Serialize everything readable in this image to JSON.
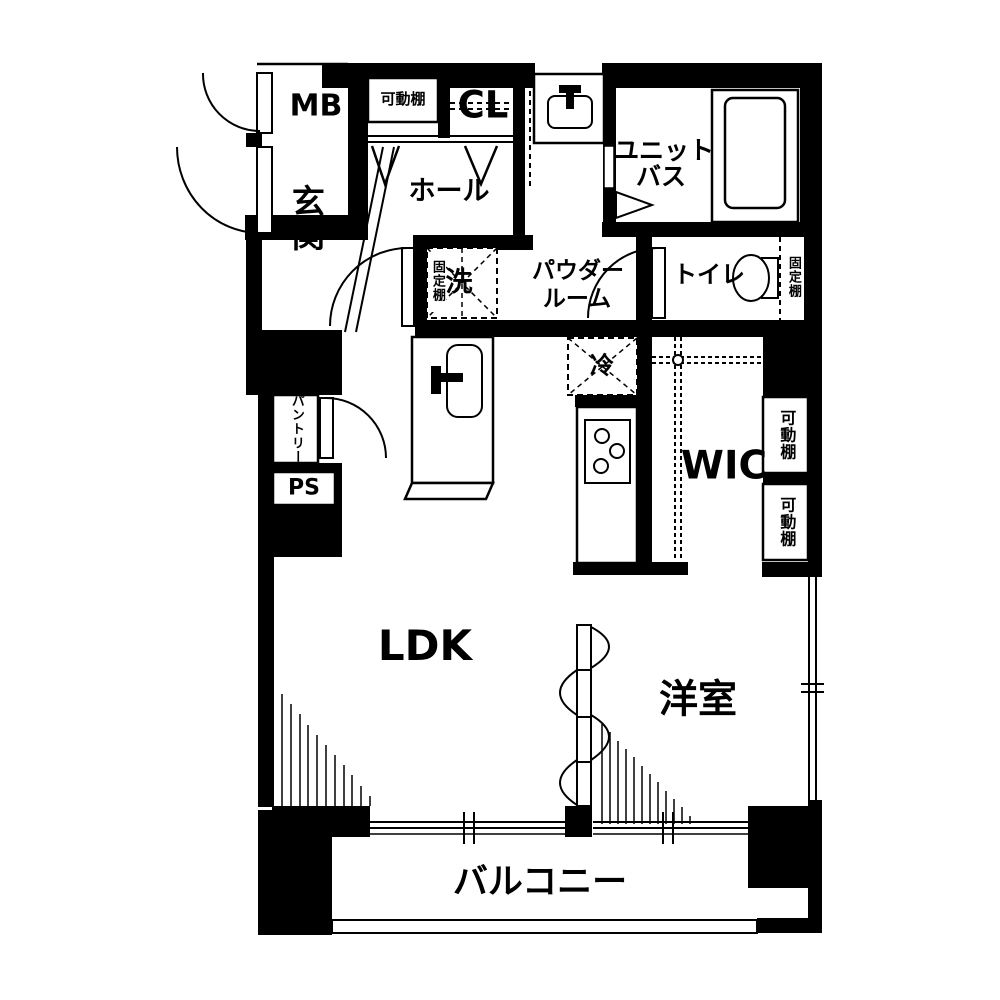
{
  "floor_plan": {
    "labels": {
      "mb": "MB",
      "shelf_top": "可動棚",
      "closet": "CL",
      "unit_bath_line1": "ユニット",
      "unit_bath_line2": "バス",
      "entrance": "玄関",
      "hall": "ホール",
      "washer": "洗",
      "fixed_shelf_washer": "固定棚",
      "powder_line1": "パウダー",
      "powder_line2": "ルーム",
      "toilet": "トイレ",
      "fixed_shelf_toilet": "固定棚",
      "fridge": "冷",
      "wic": "WIC",
      "shelf_right_1": "可動棚",
      "shelf_right_2": "可動棚",
      "pantry": "パントリー",
      "ps": "PS",
      "ldk": "LDK",
      "western_room": "洋室",
      "balcony": "バルコニー"
    },
    "colors": {
      "wall": "#000000",
      "floor": "#ffffff"
    }
  }
}
